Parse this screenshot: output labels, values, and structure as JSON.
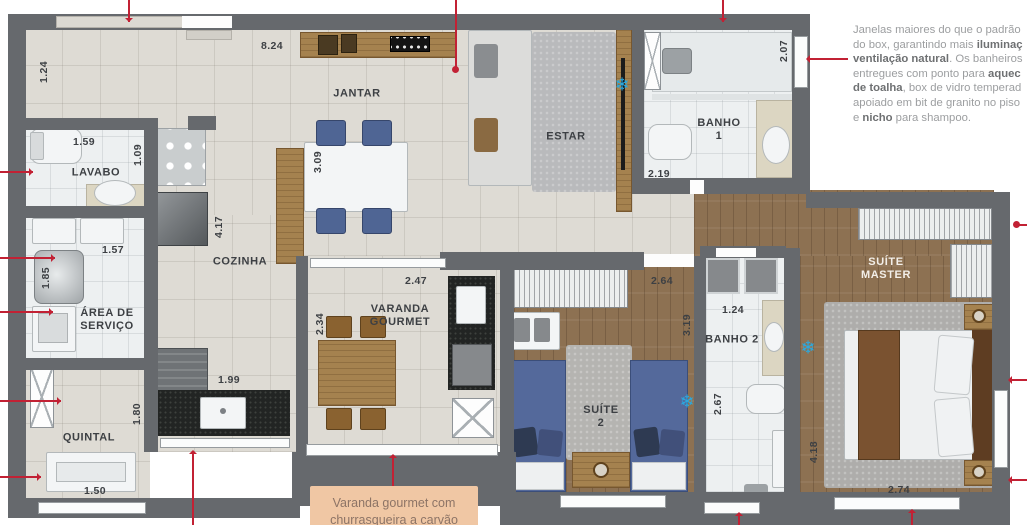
{
  "colors": {
    "callout_red": "#c22134",
    "ac_point_blue": "#2aa9e0",
    "wall_gray": "#66696d",
    "wood_floor": "#8d7152",
    "caption_bg": "#f0c7a4",
    "caption_text": "#8d7466",
    "annotation_text": "#9c9ea0",
    "annotation_bold": "#6e7072",
    "label_text": "#3d4044"
  },
  "icons": {
    "ac": "❄"
  },
  "plan": {
    "rooms": {
      "jantar": "JANTAR",
      "estar": "ESTAR",
      "lavabo": "LAVABO",
      "cozinha": "COZINHA",
      "area_servico": "ÁREA DE\nSERVIÇO",
      "quintal": "QUINTAL",
      "varanda": "VARANDA\nGOURMET",
      "banho1": "BANHO\n1",
      "banho2": "BANHO 2",
      "suite2": "SUÍTE\n2",
      "suite_master": "SUÍTE\nMASTER"
    },
    "dims": [
      "8.24",
      "1.24",
      "1.59",
      "1.09",
      "3.09",
      "4.17",
      "1.57",
      "1.85",
      "1.99",
      "1.80",
      "1.50",
      "2.34",
      "2.47",
      "2.64",
      "3.19",
      "1.24",
      "2.67",
      "2.19",
      "2.07",
      "4.18",
      "2.74"
    ]
  },
  "annotation": {
    "lines": [
      [
        {
          "t": "Janelas maiores do que o padrão",
          "b": false
        }
      ],
      [
        {
          "t": "do box, garantindo mais ",
          "b": false
        },
        {
          "t": "iluminaç",
          "b": true
        }
      ],
      [
        {
          "t": "ventilação natural",
          "b": true
        },
        {
          "t": ". Os banheiros",
          "b": false
        }
      ],
      [
        {
          "t": "entregues com ponto para ",
          "b": false
        },
        {
          "t": "aquec",
          "b": true
        }
      ],
      [
        {
          "t": "de toalha",
          "b": true
        },
        {
          "t": ", box de vidro temperad",
          "b": false
        }
      ],
      [
        {
          "t": "apoiado em bit de granito no piso",
          "b": false
        }
      ],
      [
        {
          "t": "e ",
          "b": false
        },
        {
          "t": "nicho",
          "b": true
        },
        {
          "t": " para shampoo.",
          "b": false
        }
      ]
    ]
  },
  "caption": {
    "line1": "Varanda gourmet com",
    "line2": "churrasqueira a carvão"
  }
}
